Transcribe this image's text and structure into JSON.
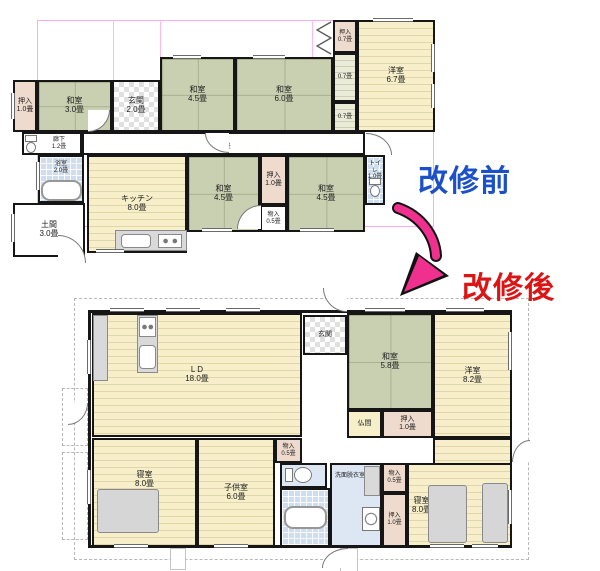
{
  "titles": {
    "before": "改修前",
    "after": "改修後"
  },
  "palette": {
    "tatami_green": "#c9cfb1",
    "wood_floor": "#f6efca",
    "closet_pink": "#eedbcd",
    "wet_blue": "#cfdeee",
    "wall_black": "#161616",
    "boundary_pink": "#ffaaec",
    "title_before_blue": "#1b50c8",
    "title_after_red": "#dc1414",
    "arrow_pink": "#f0308e"
  },
  "icons": {
    "toilet-icon": "css-tank-and-bowl",
    "bathtub-icon": "css-rounded-rect",
    "stove-icon": "css-burner-circles",
    "sink-icon": "css-rounded-rect",
    "washing-machine-icon": "css-circle-in-square",
    "bed-icon": "css-gray-rect",
    "folding-door-icon": "svg-zigzag",
    "door-arc": "css-quarter-circle",
    "renovation-arrow-icon": "svg-curved-arrow"
  },
  "before": {
    "rooms": [
      {
        "label": "押入\n1.0畳"
      },
      {
        "label": "和室\n3.0畳"
      },
      {
        "label": "玄関\n2.0畳"
      },
      {
        "label": "和室\n4.5畳"
      },
      {
        "label": "和室\n6.0畳"
      },
      {
        "label": "押入\n0.7畳"
      },
      {
        "label": "0.7畳"
      },
      {
        "label": "0.7畳"
      },
      {
        "label": "洋室\n6.7畳"
      },
      {
        "label": "廊下\n1.2畳"
      },
      {
        "label": "廊下\n6.0畳"
      },
      {
        "label": "浴室\n2.0畳"
      },
      {
        "label": "キッチン\n8.0畳"
      },
      {
        "label": "和室\n4.5畳"
      },
      {
        "label": "押入\n1.0畳"
      },
      {
        "label": "物入\n0.5畳"
      },
      {
        "label": "和室\n4.5畳"
      },
      {
        "label": "トイレ\n1.0畳"
      },
      {
        "label": "土間\n3.0畳"
      }
    ]
  },
  "after": {
    "rooms": [
      {
        "label": "L D\n18.0畳"
      },
      {
        "label": "玄関"
      },
      {
        "label": "和室\n5.8畳"
      },
      {
        "label": "洋室\n8.2畳"
      },
      {
        "label": "仏間"
      },
      {
        "label": "押入\n1.0畳"
      },
      {
        "label": "寝室\n8.0畳"
      },
      {
        "label": "子供室\n6.0畳"
      },
      {
        "label": "物入\n0.5畳"
      },
      {
        "label": "洗面脱衣室"
      },
      {
        "label": "物入\n0.5畳"
      },
      {
        "label": "押入\n1.0畳"
      },
      {
        "label": "寝室\n8.0畳"
      }
    ]
  }
}
